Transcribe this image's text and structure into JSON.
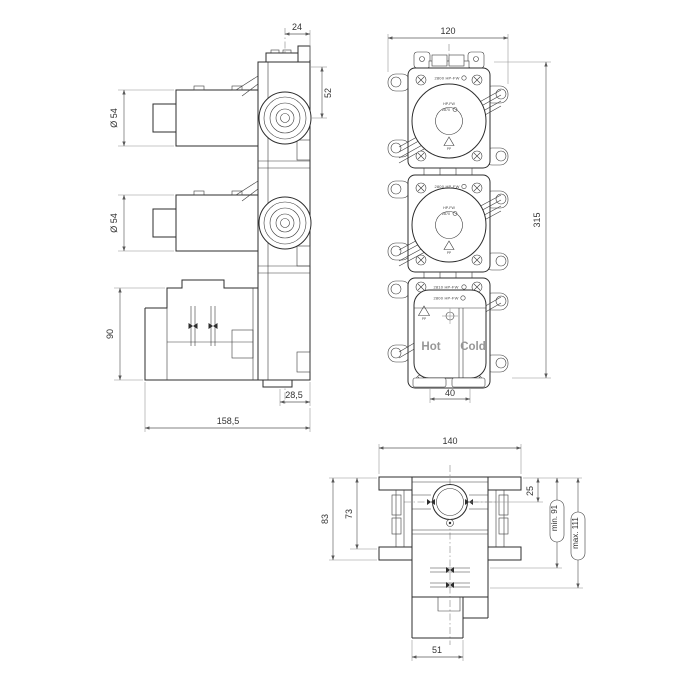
{
  "drawing": {
    "side_view": {
      "dim_top_depth": "24",
      "dim_port_offset": "52",
      "dim_port1_diameter": "Ø 54",
      "dim_port2_diameter": "Ø 54",
      "dim_body_height": "90",
      "dim_wall_offset": "28,5",
      "dim_total_depth": "158,5"
    },
    "front_view": {
      "dim_width": "120",
      "dim_height": "315",
      "dim_inlet_spacing": "40",
      "label_hot": "Hot",
      "label_cold": "Cold",
      "marking_box1": "2800 HP-FW",
      "marking_box2": "2800 HP-FW",
      "marking_box3_row1": "2810 HP-FW",
      "marking_box3_row2": "2800 HP-FW",
      "dial_marking_line1": "HP-FW",
      "dial_marking_line2": "2870",
      "symbol_pp": "PP"
    },
    "bottom_view": {
      "dim_width": "140",
      "dim_port_depth": "25",
      "dim_depth_73": "73",
      "dim_depth_83": "83",
      "dim_min_depth": "min. 91",
      "dim_max_depth": "max. 111",
      "dim_outlet_width": "51"
    },
    "colors": {
      "line": "#2d2d2d",
      "dimension": "#5a5a5a",
      "label_gray": "#979797",
      "background": "#ffffff"
    }
  }
}
